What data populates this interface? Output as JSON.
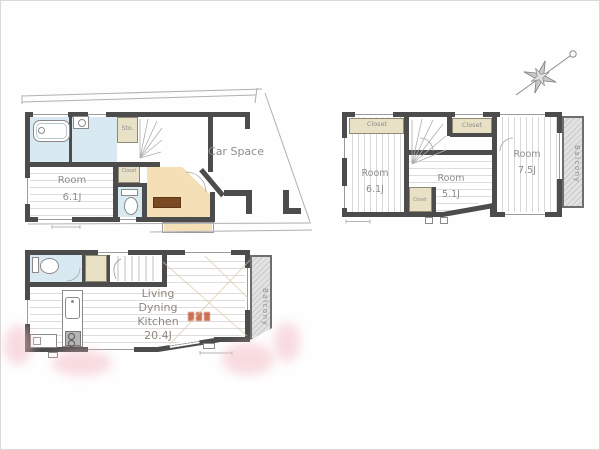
{
  "labels": {
    "car_space": "Car Space",
    "room": "Room",
    "closet": "Closet",
    "sto": "Sto.",
    "balcony": "Balcony"
  },
  "first_floor": {
    "room_size": "6.1J"
  },
  "second_floor": {
    "room_left_size": "6.1J",
    "room_center_size": "5.1J",
    "room_right_size": "7.5J"
  },
  "third_floor": {
    "ldk_line1": "Living",
    "ldk_line2": "Dyning",
    "ldk_line3": "Kitchen",
    "ldk_size": "20.4J"
  },
  "colors": {
    "wall": "#4c4c4c",
    "wet_area": "#d8e9f1",
    "closet_beige": "#e9e1c6",
    "entrance_tan": "#f4dfb6",
    "balcony_gray": "#d6d6d6",
    "stamp_orange": "#c25a38",
    "watermark_pink": "#f3b9c2",
    "label_gray": "#8d8d8d"
  }
}
